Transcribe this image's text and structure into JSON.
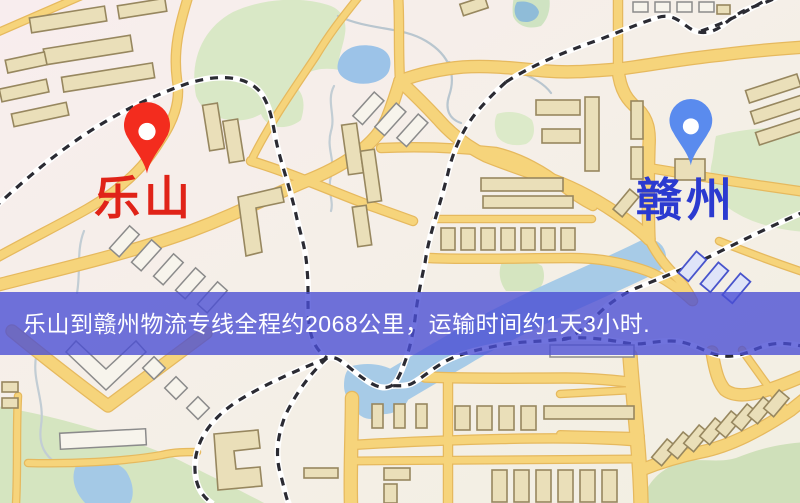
{
  "banner": {
    "text": "乐山到赣州物流专线全程约2068公里，运输时间约1天3小时.",
    "background": "#4a4ed4c9",
    "text_color": "#ffffff"
  },
  "origin": {
    "name": "乐山",
    "pin_color": "#f32c1e",
    "label_color": "#e02318"
  },
  "destination": {
    "name": "赣州",
    "pin_color": "#5a8bee",
    "label_color": "#2b3ad0"
  },
  "route": {
    "distance_text": "约2068公里",
    "duration_text": "约1天3小时"
  },
  "theme": {
    "background": "#f4efe6",
    "road": "#f6d47b",
    "road_casing": "#e6b95e",
    "park": "#d8e7c5",
    "water": "#9fc6e8",
    "railway_dash": "#2b2b33",
    "building": "#eadfb9"
  }
}
